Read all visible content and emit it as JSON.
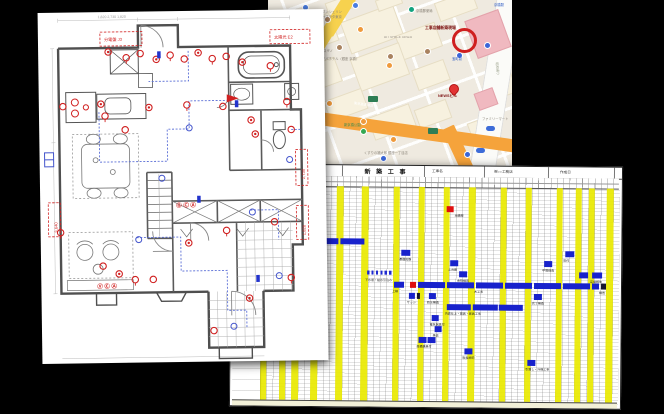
{
  "scene": {
    "background": "#000000",
    "description_pages": [
      "floor-plan-drawing",
      "neighborhood-map",
      "construction-schedule-gantt"
    ]
  },
  "map": {
    "site_label": "工事店舗新築現場",
    "pin_label": "NEWSビル",
    "street_label_vertical": "昭和通り",
    "expressway_label": "東京高速道路",
    "colors": {
      "bg": "#efeae0",
      "road_yellow": "#f7d24e",
      "road_orange": "#f5a33b",
      "station_pink": "#f0b9c0",
      "avenue": "#fbfbf8",
      "circle_red": "#cf1f1f"
    },
    "blocks": [
      [
        16,
        20,
        50,
        28
      ],
      [
        76,
        12,
        54,
        32
      ],
      [
        130,
        28,
        40,
        24
      ],
      [
        24,
        64,
        46,
        24
      ],
      [
        86,
        50,
        50,
        32
      ],
      [
        146,
        64,
        32,
        20
      ],
      [
        8,
        104,
        40,
        24
      ],
      [
        58,
        94,
        38,
        20
      ],
      [
        102,
        110,
        42,
        22
      ],
      [
        148,
        104,
        32,
        18
      ],
      [
        226,
        58,
        16,
        36
      ],
      [
        168,
        -4,
        38,
        18
      ],
      [
        58,
        -2,
        28,
        12
      ],
      [
        108,
        -4,
        24,
        10
      ],
      [
        0,
        38,
        12,
        24
      ],
      [
        204,
        118,
        26,
        34
      ]
    ],
    "roads": [
      {
        "cx": 227,
        "cy": 85,
        "w": 24,
        "h": 190,
        "rot": 9,
        "color": "#fbfbf8",
        "name": "avenue"
      },
      {
        "cx": 71,
        "cy": 14,
        "w": 13,
        "h": 46,
        "rot": 32,
        "color": "#f7d24e",
        "name": "yellow-road"
      },
      {
        "cx": 54,
        "cy": 43,
        "w": 10,
        "h": 30,
        "rot": 32,
        "color": "#f7d24e",
        "name": "yellow-road-2"
      },
      {
        "cx": 150,
        "cy": 132,
        "w": 205,
        "h": 13,
        "rot": 8,
        "color": "#f5a33b",
        "name": "expressway"
      },
      {
        "cx": 190,
        "cy": 150,
        "w": 13,
        "h": 50,
        "rot": -25,
        "color": "#f5a33b",
        "name": "expressway-branch"
      }
    ],
    "pink_blocks": [
      [
        202,
        14,
        34,
        38
      ],
      [
        208,
        90,
        18,
        16
      ]
    ],
    "site_circle": {
      "x": 184,
      "y": 28
    },
    "pin": {
      "x": 181,
      "y": 84
    },
    "icons": [
      [
        34,
        4,
        "#4a7de0"
      ],
      [
        84,
        2,
        "#4a7de0"
      ],
      [
        188,
        52,
        "#3a66d8"
      ],
      [
        112,
        155,
        "#3a66d8"
      ],
      [
        196,
        151,
        "#3a66d8"
      ],
      [
        216,
        42,
        "#3a66d8"
      ],
      [
        40,
        15,
        "#ef9a3c"
      ],
      [
        89,
        26,
        "#ef9a3c"
      ],
      [
        118,
        62,
        "#ef9a3c"
      ],
      [
        92,
        118,
        "#ef9a3c"
      ],
      [
        122,
        136,
        "#ef9a3c"
      ],
      [
        58,
        100,
        "#ef9a3c"
      ],
      [
        56,
        16,
        "#a9825f"
      ],
      [
        156,
        48,
        "#a9825f"
      ],
      [
        119,
        53,
        "#a9825f"
      ],
      [
        68,
        44,
        "#a9825f"
      ],
      [
        140,
        6,
        "#12a37f"
      ],
      [
        92,
        128,
        "#34a853"
      ]
    ],
    "shields": [
      [
        100,
        96
      ],
      [
        160,
        128
      ]
    ],
    "ovals": [
      [
        208,
        148
      ],
      [
        218,
        126
      ]
    ],
    "labels": [
      {
        "x": 54,
        "y": 11,
        "t": "ダンシェリン"
      },
      {
        "x": 54,
        "y": 16,
        "t": "オブラタ東京"
      },
      {
        "x": 116,
        "y": 36,
        "t": "AIT SPACE GINZA",
        "c": "#9a938a"
      },
      {
        "x": 42,
        "y": 50,
        "t": "イデミ・スギノ"
      },
      {
        "x": 54,
        "y": 58,
        "t": "アパホテル〈銀座 京橋〉"
      },
      {
        "x": 148,
        "y": 10,
        "t": "京橋郵便局"
      },
      {
        "x": 226,
        "y": 4,
        "t": "京橋駅",
        "c": "#2b59c3"
      },
      {
        "x": 184,
        "y": 58,
        "t": "宝町駅",
        "c": "#2b59c3"
      },
      {
        "x": 4,
        "y": 106,
        "t": "グランドダイニング 銀座本木店"
      },
      {
        "x": 76,
        "y": 124,
        "t": "新京橋公園",
        "c": "#3c8a4e"
      },
      {
        "x": 96,
        "y": 152,
        "t": "くすりの福太郎 銀座一丁目店"
      },
      {
        "x": 214,
        "y": 118,
        "t": "ファミリーマート"
      },
      {
        "x": 157,
        "y": 26,
        "t": "工事店舗新築現場",
        "c": "#7d1212",
        "b": 1
      },
      {
        "x": 170,
        "y": 94,
        "t": "NEWSビル",
        "c": "#7d1212",
        "b": 1
      },
      {
        "x": 86,
        "y": 102,
        "t": "東京高速道路",
        "c": "#ffffff",
        "rot": 8
      },
      {
        "x": 230,
        "y": 62,
        "t": "昭和通り",
        "c": "#9aa08a",
        "rot": 85
      }
    ]
  },
  "gantt": {
    "title": "新 築 工 事",
    "header_fields": [
      {
        "x": 200,
        "t": "工事名"
      },
      {
        "x": 262,
        "t": "㈱○○工務店"
      },
      {
        "x": 328,
        "t": "作成日"
      }
    ],
    "header_dividers": [
      110,
      192,
      252,
      316,
      382
    ],
    "grid": {
      "x0": 30,
      "y0": 21,
      "colW": 6.28,
      "rowH": 10.9,
      "cols": 57,
      "height": 216
    },
    "holiday_cols": [
      0,
      3,
      5,
      8,
      12,
      16,
      21,
      25,
      29,
      33,
      38,
      42,
      47,
      50,
      52,
      55
    ],
    "row_labels": [
      {
        "r": 15,
        "t": "外構工事"
      }
    ],
    "bars": [
      {
        "r": 1,
        "c": 29.5,
        "w": 1,
        "t": "red",
        "l": "地鎮祭"
      },
      {
        "r": 4,
        "c": 10,
        "w": 2.2
      },
      {
        "r": 4,
        "c": 12.6,
        "w": 3.8
      },
      {
        "r": 5,
        "c": 22.3,
        "w": 1.4,
        "l": "基礎配筋"
      },
      {
        "r": 5,
        "c": 48.4,
        "w": 1.4,
        "l": "吹付"
      },
      {
        "r": 6,
        "c": 30.1,
        "w": 1.3,
        "l": "土台敷"
      },
      {
        "r": 6,
        "c": 45,
        "w": 1.3,
        "l": "中間検査"
      },
      {
        "r": 7,
        "c": 16.9,
        "w": 3.9,
        "t": "dotted",
        "l": "下水道・給水引込み"
      },
      {
        "r": 7,
        "c": 31.5,
        "w": 1.3,
        "l": "金物検査"
      },
      {
        "r": 7,
        "c": 50.6,
        "w": 1.4
      },
      {
        "r": 7,
        "c": 52.7,
        "w": 1.6,
        "l": "足場解体"
      },
      {
        "r": 8,
        "c": 21.2,
        "w": 1.6,
        "l": "上棟"
      },
      {
        "r": 8,
        "c": 23.7,
        "w": 1,
        "t": "red"
      },
      {
        "r": 8,
        "c": 25,
        "w": 4.3
      },
      {
        "r": 8,
        "c": 29.6,
        "w": 4.3
      },
      {
        "r": 8,
        "c": 34.2,
        "w": 4.3,
        "l": "木工事"
      },
      {
        "r": 8,
        "c": 38.9,
        "w": 4.3
      },
      {
        "r": 8,
        "c": 43.5,
        "w": 4.3
      },
      {
        "r": 8,
        "c": 48.1,
        "w": 4.3
      },
      {
        "r": 8,
        "c": 52.7,
        "w": 1.2
      },
      {
        "r": 8,
        "c": 54.1,
        "w": 0.8,
        "t": "dark",
        "l": "検査"
      },
      {
        "r": 9,
        "c": 23.6,
        "w": 1,
        "l": "サッシ"
      },
      {
        "r": 9,
        "c": 24.8,
        "w": 0.5,
        "t": "dark"
      },
      {
        "r": 9,
        "c": 26.7,
        "w": 1.2,
        "l": "防水検査"
      },
      {
        "r": 9,
        "c": 43.5,
        "w": 1.3,
        "l": "完了検査"
      },
      {
        "r": 10,
        "c": 29.6,
        "w": 3.9,
        "l": "内装仕上・建具・家具工事"
      },
      {
        "r": 10,
        "c": 33.8,
        "w": 3.9
      },
      {
        "r": 10,
        "c": 37.9,
        "w": 3.9
      },
      {
        "r": 11,
        "c": 27.2,
        "w": 1.2,
        "l": "電気器具付"
      },
      {
        "r": 12,
        "c": 27.7,
        "w": 1.2,
        "l": "美装"
      },
      {
        "r": 13,
        "c": 25.2,
        "w": 1.2,
        "l": "設備器具付"
      },
      {
        "r": 13,
        "c": 26.6,
        "w": 1.2
      },
      {
        "r": 14,
        "c": 32.5,
        "w": 1.3,
        "l": "取扱説明"
      },
      {
        "r": 15,
        "c": 42.5,
        "w": 1.3,
        "l": "引渡し・外構工事"
      }
    ]
  },
  "floorplan": {
    "annotations": {
      "box_top_left": "分電盤 J3",
      "box_top_right": "太陽光 E2",
      "dim_right_1": "2,730",
      "dim_right_2": "1,820",
      "dim_left": "3,640",
      "stamps_center": "Ⓖ Ⓒ Ⓐ",
      "stamps_bottom": "Ⓥ Ⓒ Ⓐ",
      "dims_top": "1,820   2,730   1,820"
    },
    "outlet_symbols": [
      [
        70,
        40
      ],
      [
        88,
        46
      ],
      [
        102,
        42
      ],
      [
        118,
        48
      ],
      [
        132,
        44
      ],
      [
        146,
        48
      ],
      [
        160,
        42
      ],
      [
        174,
        48
      ],
      [
        188,
        46
      ],
      [
        204,
        52
      ],
      [
        232,
        56
      ],
      [
        24,
        94
      ],
      [
        62,
        92
      ],
      [
        66,
        104
      ],
      [
        86,
        118
      ],
      [
        110,
        96
      ],
      [
        148,
        94
      ],
      [
        184,
        96
      ],
      [
        212,
        110
      ],
      [
        248,
        92
      ],
      [
        252,
        120
      ],
      [
        216,
        124
      ],
      [
        20,
        220
      ],
      [
        62,
        254
      ],
      [
        78,
        262
      ],
      [
        94,
        268
      ],
      [
        112,
        268
      ],
      [
        148,
        232
      ],
      [
        186,
        220
      ],
      [
        234,
        212
      ],
      [
        208,
        288
      ],
      [
        250,
        268
      ],
      [
        172,
        320
      ]
    ],
    "blue_nodes": [
      [
        150,
        117
      ],
      [
        122,
        167
      ],
      [
        212,
        202
      ],
      [
        238,
        266
      ],
      [
        98,
        228
      ],
      [
        192,
        316
      ],
      [
        250,
        150
      ]
    ],
    "blue_switches": [
      [
        157,
        185
      ],
      [
        215,
        265
      ],
      [
        119,
        40
      ],
      [
        196,
        90
      ]
    ],
    "colors": {
      "wall": "#4f4f4f",
      "red": "#d02020",
      "blue": "#5b6fd6"
    }
  }
}
